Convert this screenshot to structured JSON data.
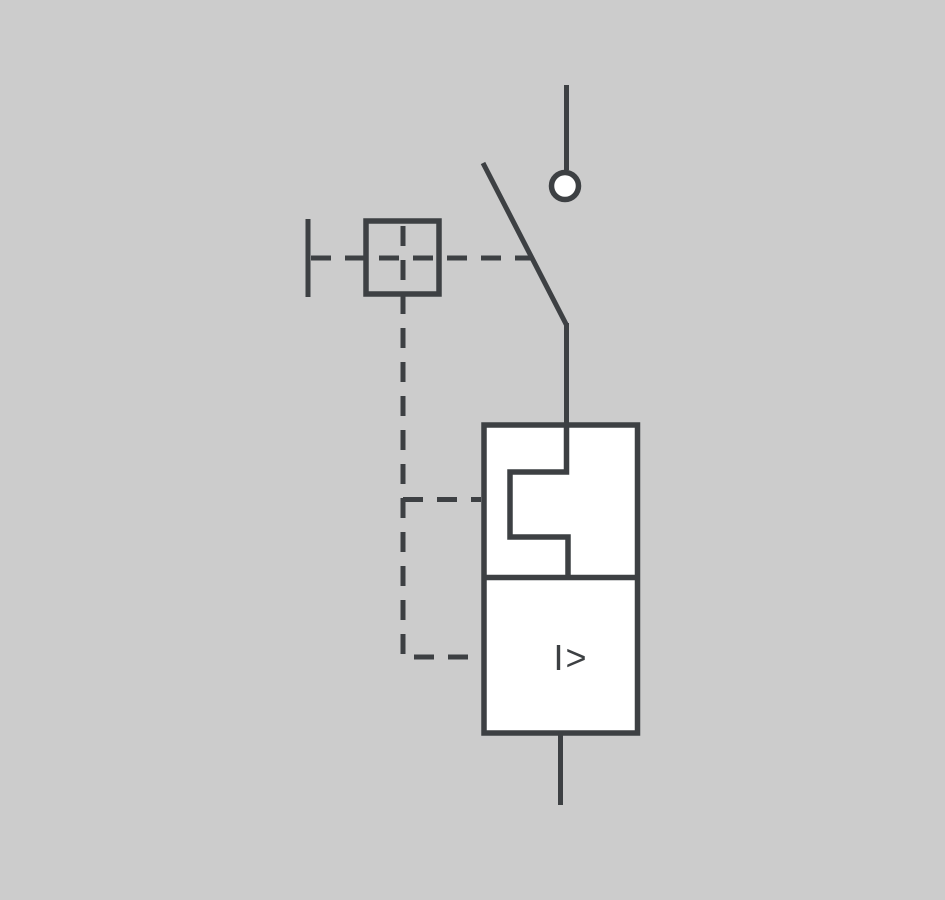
{
  "diagram": {
    "labels": {
      "overcurrent_release": "I>"
    },
    "colors": {
      "background": "#cccccc",
      "stroke": "#3d4043",
      "component_fill": "#ffffff"
    }
  }
}
